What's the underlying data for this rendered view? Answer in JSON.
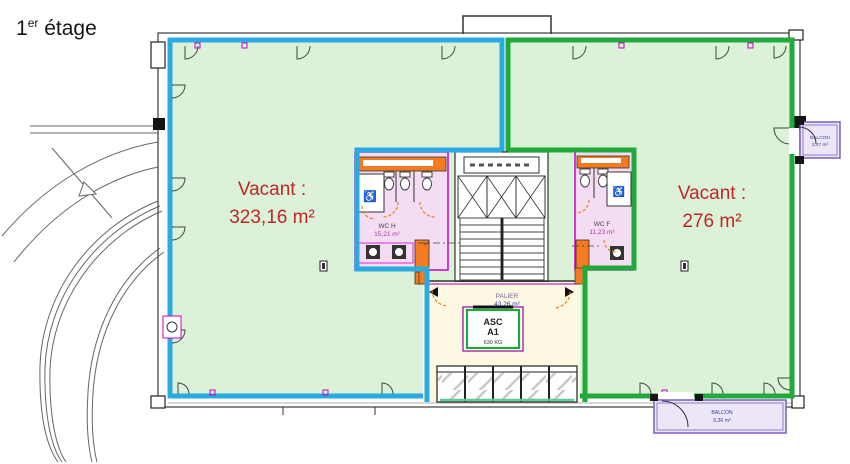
{
  "title": {
    "number": "1",
    "ordinal": "er",
    "word": " étage"
  },
  "zones": {
    "left": {
      "label": "Vacant :",
      "area": "323,16 m²",
      "outline": "#29abe2"
    },
    "right": {
      "label": "Vacant :",
      "area": "276 m²",
      "outline": "#22a93c"
    }
  },
  "core": {
    "wc_men": {
      "name": "WC H",
      "area": "15,21 m²"
    },
    "wc_women": {
      "name": "WC F",
      "area": "11,23 m²"
    },
    "landing": {
      "name": "PALIER",
      "area": "43,26 m²"
    },
    "elevator": {
      "name": "ASC",
      "id": "A1",
      "capacity": "630 KG"
    },
    "wheelchair_icon": "♿"
  },
  "balconies": {
    "right": {
      "name": "BALCON",
      "area": "3,47 m²"
    },
    "bottom": {
      "name": "BALCON",
      "area": "6,36 m²"
    }
  },
  "colors": {
    "zone_fill": "#dcf2d8",
    "left_outline": "#29abe2",
    "right_outline": "#22a93c",
    "wc_fill": "#f4dcf2",
    "wc_outline": "#cc00cc",
    "service_orange": "#f47b20",
    "landing_fill": "#fcf8e2",
    "vacant_text": "#bf2626",
    "balcony_fill": "#ece6f7",
    "balcony_outline": "#7b5ec2",
    "balcony_text": "#3b3bb0"
  }
}
